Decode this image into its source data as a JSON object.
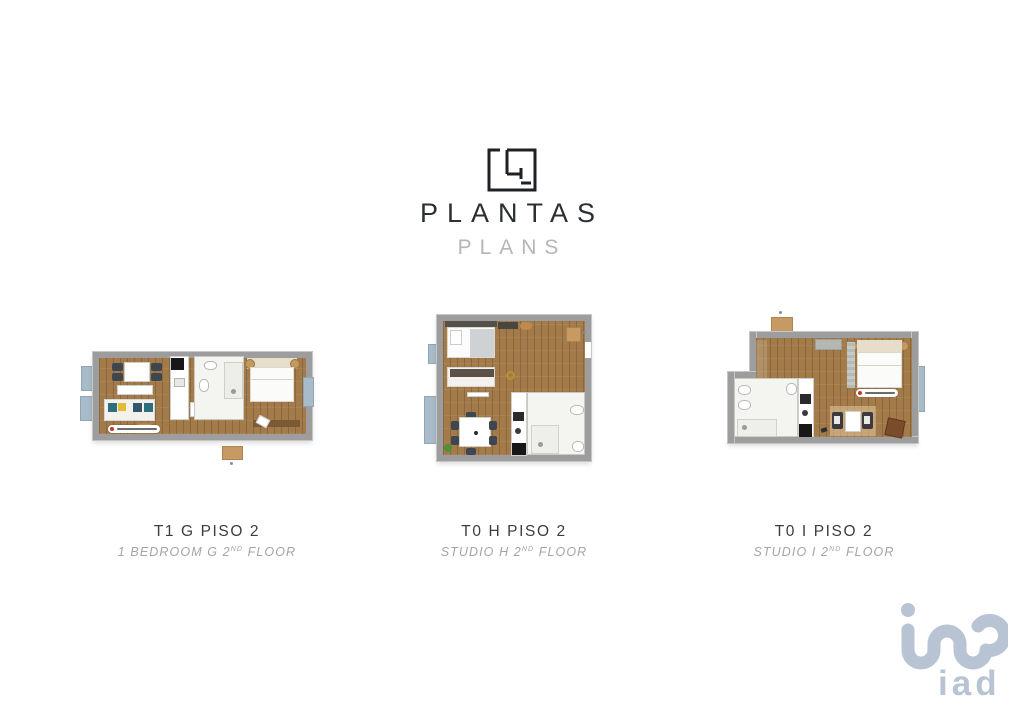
{
  "header": {
    "title": "PLANTAS",
    "subtitle": "PLANS",
    "logo_icon": "floorplan-icon"
  },
  "plans": [
    {
      "title": "T1 G PISO 2",
      "subtitle_main": "1 BEDROOM G 2",
      "subtitle_sup": "ND",
      "subtitle_end": " FLOOR"
    },
    {
      "title": "T0 H PISO 2",
      "subtitle_main": "STUDIO H 2",
      "subtitle_sup": "ND",
      "subtitle_end": " FLOOR"
    },
    {
      "title": "T0 I PISO 2",
      "subtitle_main": "STUDIO I 2",
      "subtitle_sup": "ND",
      "subtitle_end": " FLOOR"
    }
  ],
  "watermark": {
    "text": "iad",
    "icon": "iad-monogram-icon",
    "color": "#b8c3d3"
  },
  "colors": {
    "wall_gray": "#9d9d9d",
    "wood_floor": "#a37b4a",
    "window_blue": "#a8bbc8",
    "bathroom_white": "#f4f4f1",
    "title_dark": "#2b2e33",
    "subtitle_gray": "#b6b6b6",
    "badge_red": "#c0392b"
  }
}
